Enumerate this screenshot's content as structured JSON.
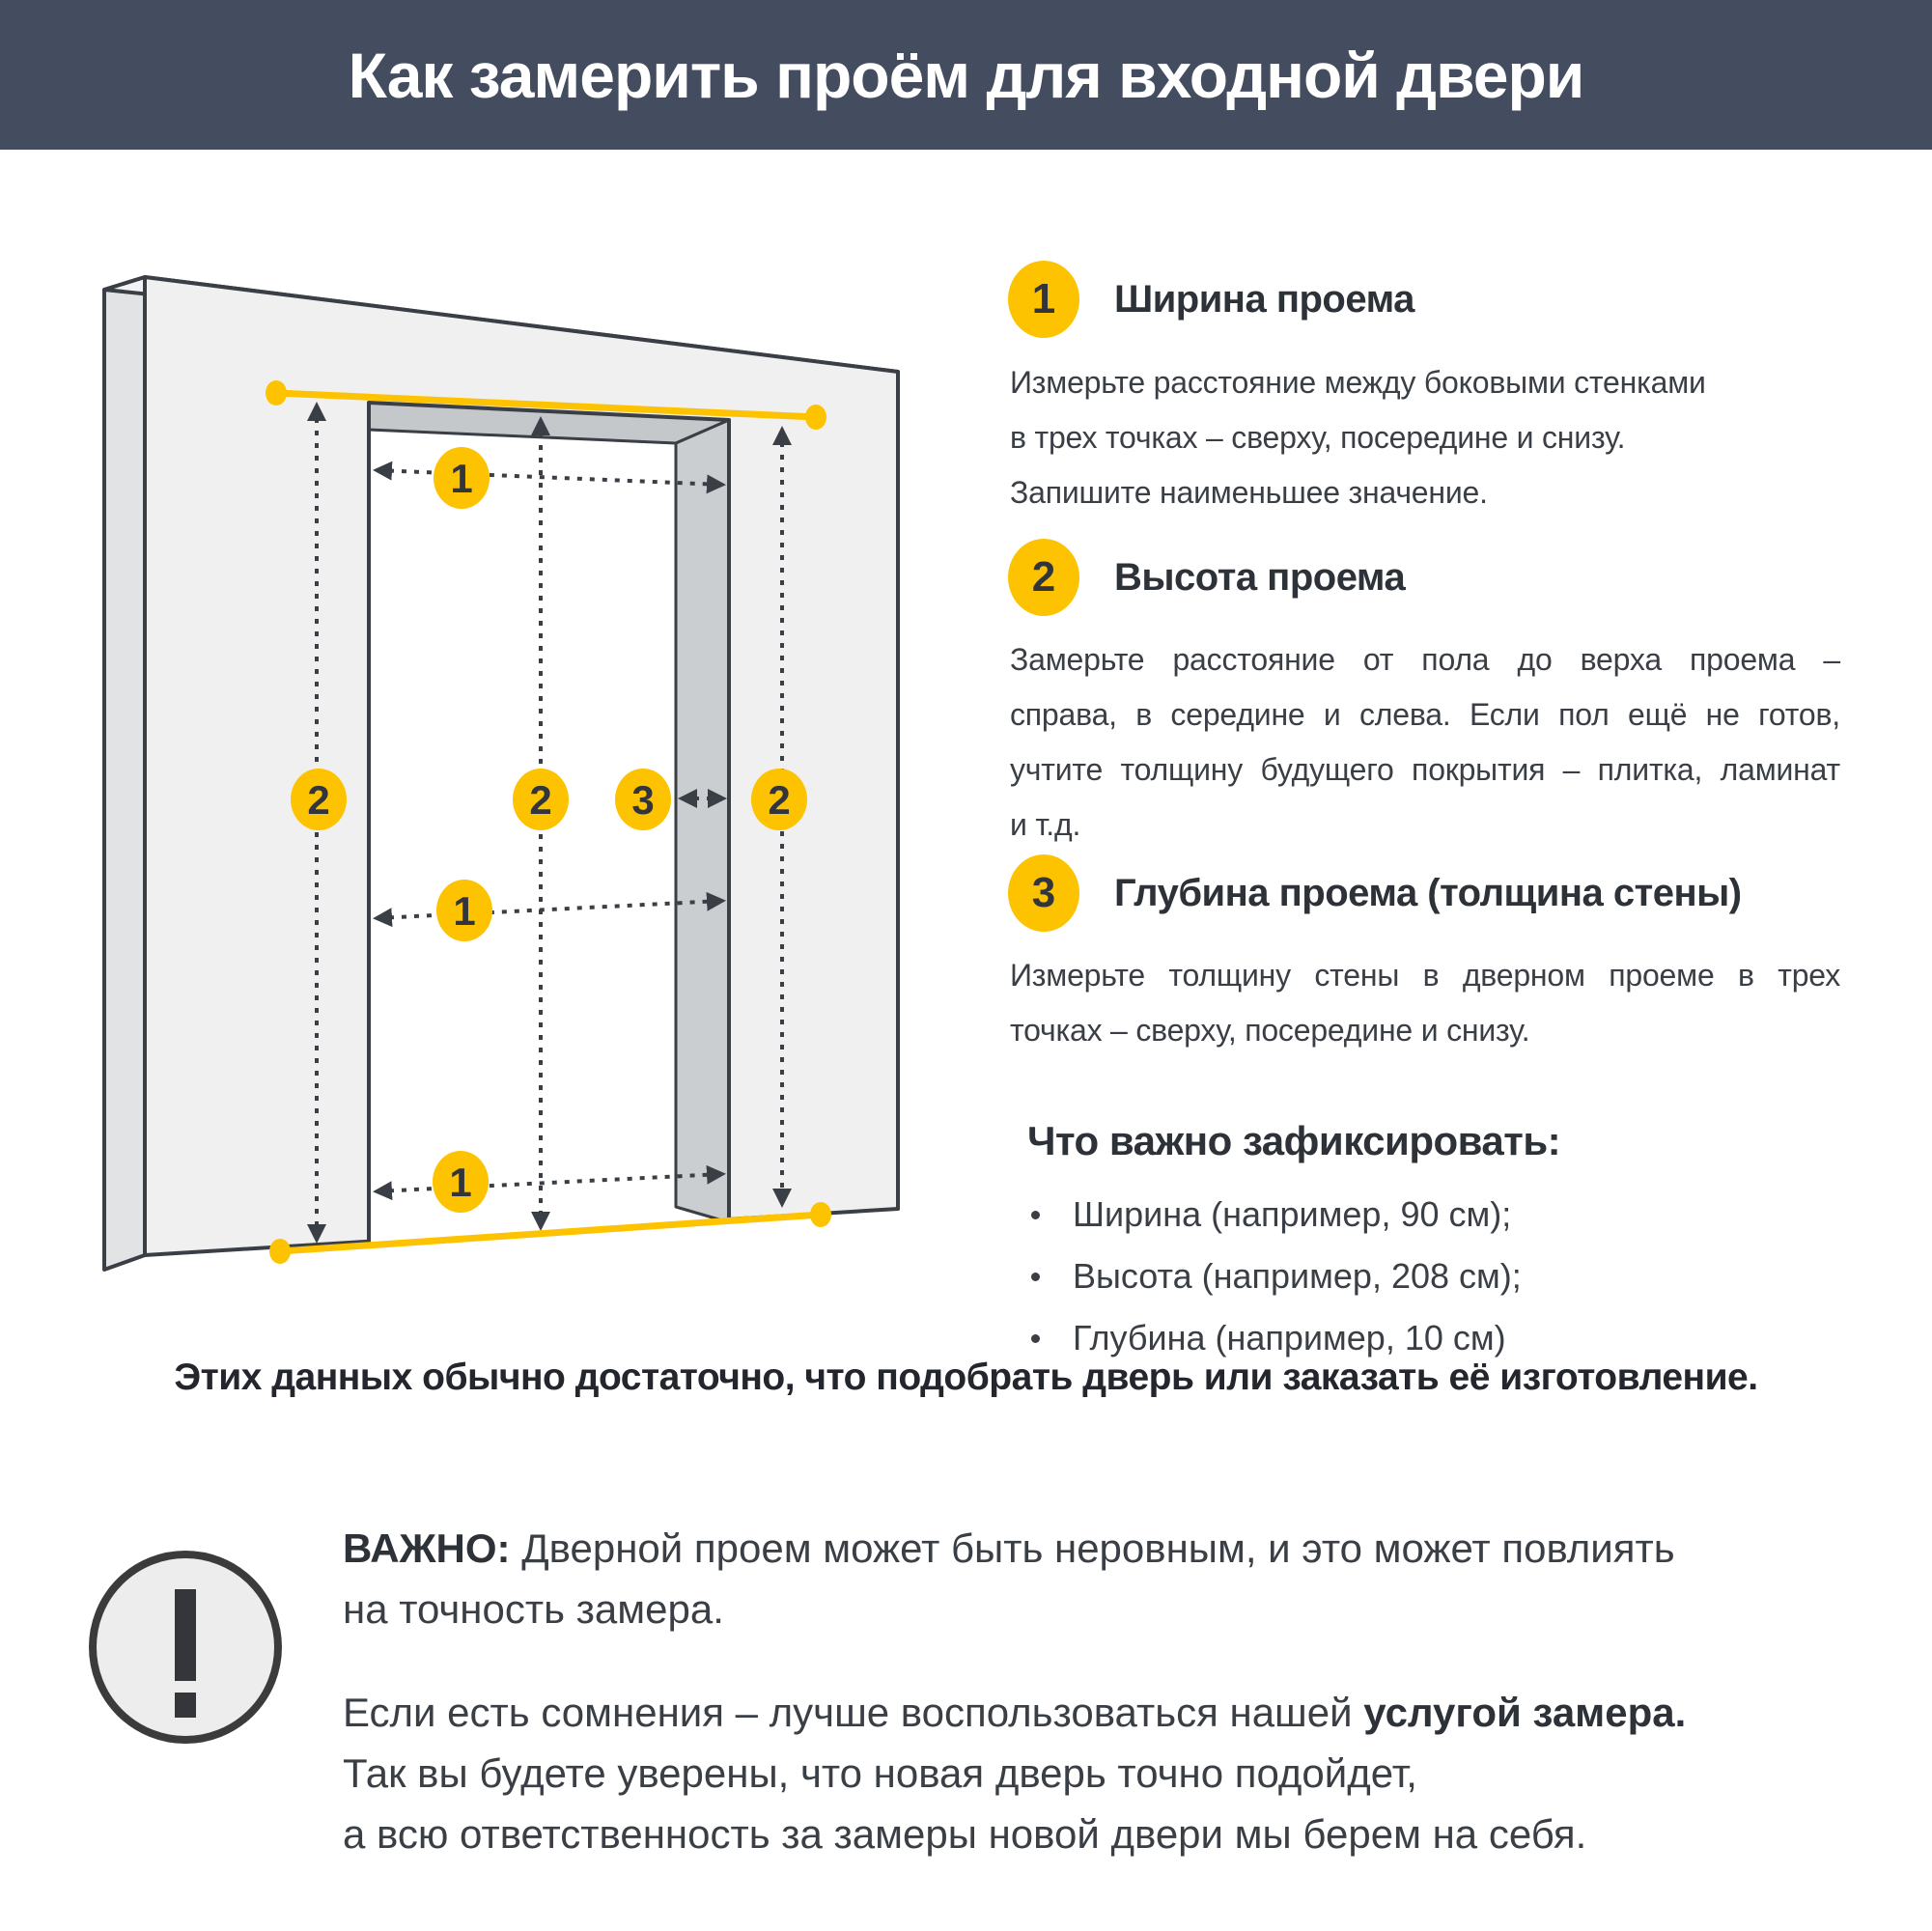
{
  "header": {
    "title": "Как замерить проём для входной двери"
  },
  "diagram": {
    "width_label": "1",
    "height_label": "2",
    "depth_label": "3"
  },
  "steps": [
    {
      "num": "1",
      "title": "Ширина проема",
      "lines": [
        "Измерьте расстояние между боковыми стенками",
        "в трех точках – сверху, посередине и снизу.",
        "Запишите наименьшее значение."
      ]
    },
    {
      "num": "2",
      "title": "Высота проема",
      "lines": [
        "Замерьте расстояние от пола до верха проема –",
        "справа, в середине и слева. Если пол ещё не готов,",
        "учтите толщину будущего покрытия – плитка, ламинат",
        "и т.д."
      ]
    },
    {
      "num": "3",
      "title": "Глубина проема (толщина стены)",
      "lines": [
        "Измерьте толщину стены в дверном проеме в трех",
        "точках – сверху, посередине и снизу."
      ]
    }
  ],
  "checklist": {
    "title": "Что важно зафиксировать:",
    "items": [
      "Ширина (например, 90 см);",
      "Высота (например, 208 см);",
      "Глубина (например, 10 см)"
    ]
  },
  "summary": "Этих данных обычно достаточно, что подобрать дверь или заказать её изготовление.",
  "important": {
    "label": "ВАЖНО:",
    "line1_rest": " Дверной проем может быть неровным, и это может повлиять",
    "line2": "на точность замера.",
    "p2_line1": "Если есть сомнения – лучше воспользоваться нашей ",
    "p2_line1_bold": "услугой замера.",
    "p2_line2": "Так вы будете уверены, что новая дверь точно подойдет,",
    "p2_line3": "а всю ответственность за замеры новой двери мы берем на себя."
  },
  "colors": {
    "accent_yellow": "#fdc300",
    "header_bg": "#434d5f",
    "outline_dark": "#3a3f46",
    "wall_front": "#f0f0f1",
    "wall_side": "#e2e3e5",
    "reveal_top": "#c5c8cb",
    "reveal_right": "#cbced1",
    "icon_gray": "#ededee"
  }
}
